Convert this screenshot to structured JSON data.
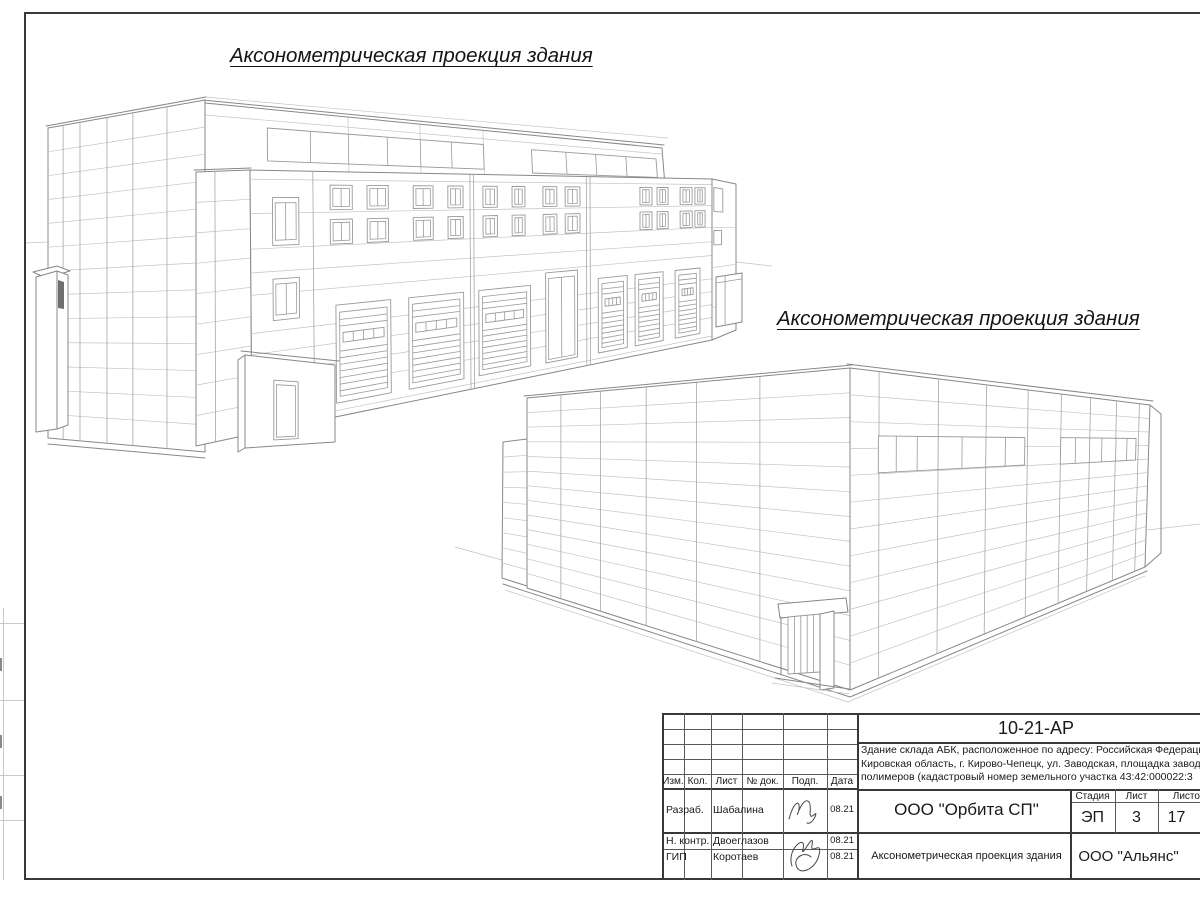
{
  "views": [
    {
      "title": "Аксонометрическая проекция здания"
    },
    {
      "title": "Аксонометрическая проекция здания"
    }
  ],
  "title_block": {
    "code": "10-21-АР",
    "address_line1": "Здание склада АБК, расположенное по адресу: Российская Федерация,",
    "address_line2": "Кировская область, г. Кирово-Чепецк, ул. Заводская, площадка завода",
    "address_line3": "полимеров (кадастровый номер земельного участка 43:42:000022:3",
    "columns": {
      "izm": "Изм.",
      "kol": "Кол.",
      "list": "Лист",
      "doc": "№ док.",
      "podp": "Подп.",
      "data": "Дата"
    },
    "rows": [
      {
        "role": "Разраб.",
        "name": "Шабалина",
        "date": "08.21"
      },
      {
        "role": "Н. контр.",
        "name": "Двоеглазов",
        "date": "08.21"
      },
      {
        "role": "ГИП",
        "name": "Коротаев",
        "date": "08.21"
      }
    ],
    "org": "ООО \"Орбита СП\"",
    "stage_label": "Стадия",
    "sheet_label": "Лист",
    "sheets_label": "Листов",
    "stage": "ЭП",
    "sheet_no": "3",
    "sheets_total": "17",
    "doc_title": "Аксонометрическая проекция здания",
    "company": "ООО \"Альянс\""
  }
}
